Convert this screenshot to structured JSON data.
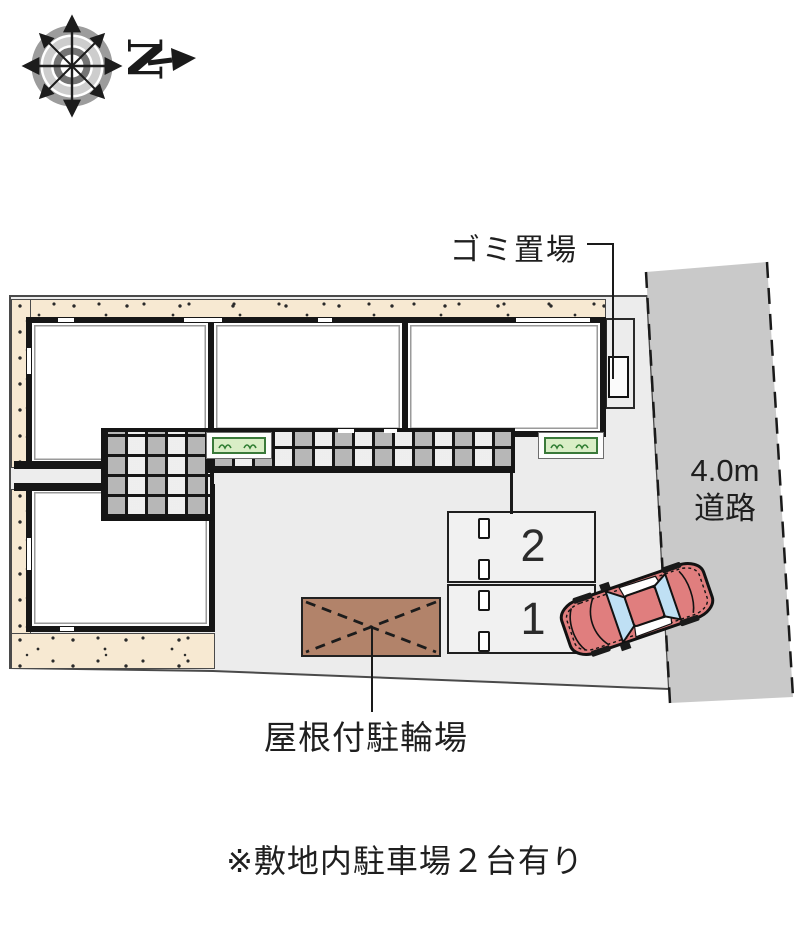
{
  "compass": {
    "letter": "N"
  },
  "labels": {
    "garbage": "ゴミ置場",
    "road_line1": "4.0m",
    "road_line2": "道路",
    "bicycle_shed": "屋根付駐輪場",
    "note": "※敷地内駐車場２台有り"
  },
  "parking": {
    "space_upper": "2",
    "space_lower": "1"
  },
  "colors": {
    "plot": "#ececec",
    "road": "#c9c9c9",
    "beige": "#f7e9d2",
    "wall": "#1a1a1a",
    "shed": "#b2836a",
    "car_body": "#e07e7e",
    "car_glass": "#bfe0f4",
    "planter_green": "#d9eec6"
  }
}
